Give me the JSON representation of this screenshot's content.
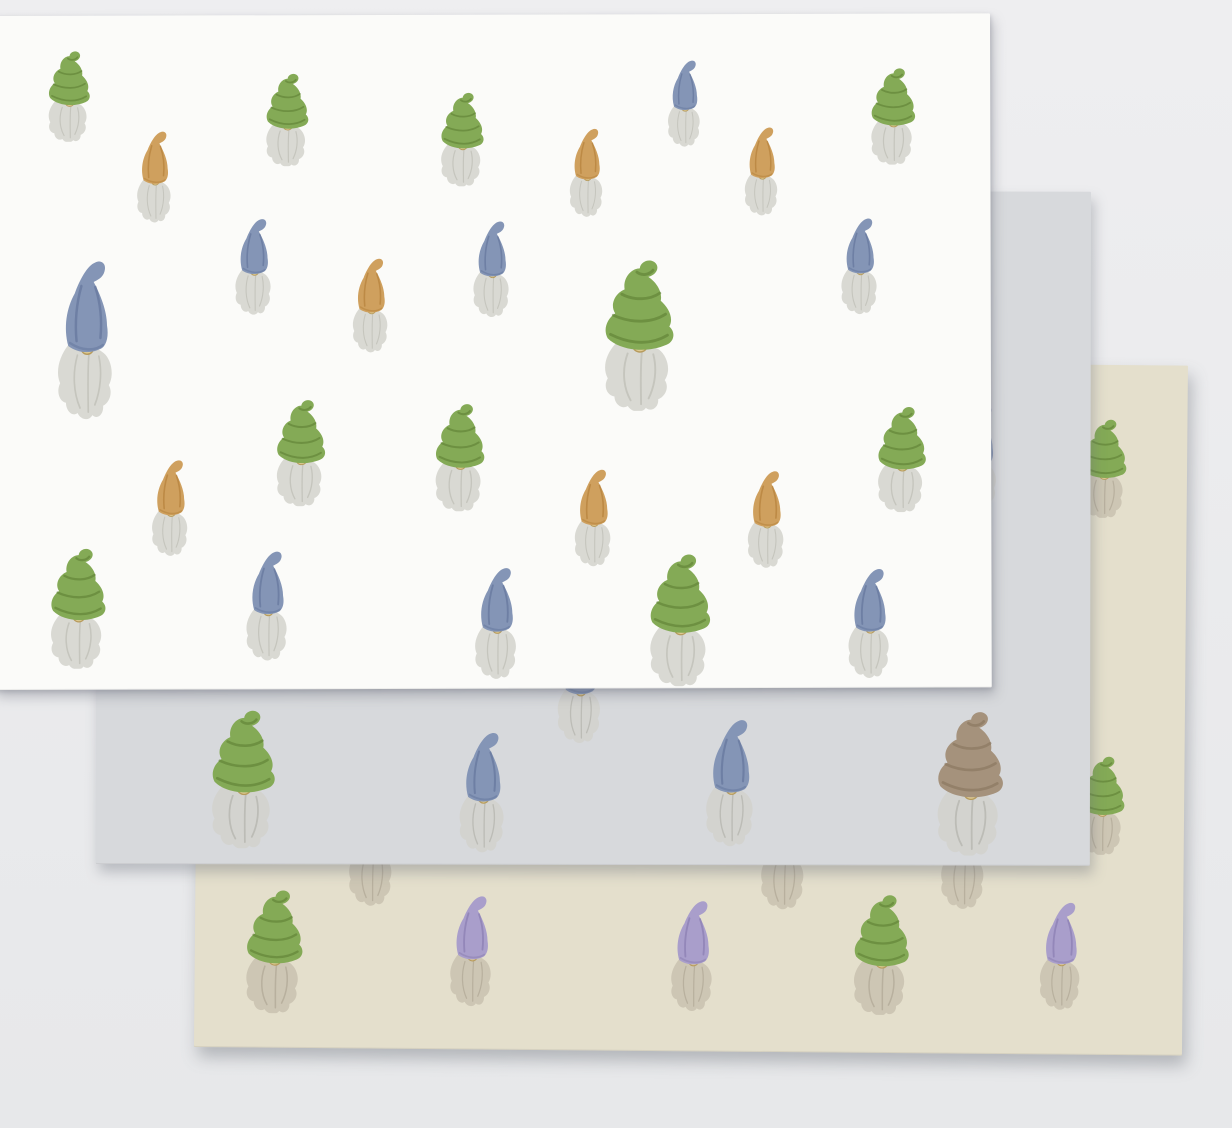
{
  "scene": {
    "type": "product-photo",
    "subject": "Three overlapping wrapping paper sheets with a watercolor gnome pattern",
    "background_top": "#eeeef0",
    "background_bottom": "#e7e8ea",
    "palette": {
      "nose": "#decb93",
      "nose_stroke": "#b79b5c",
      "hats": {
        "green": {
          "fill": "#84aa56",
          "stripe": "#5d7e33"
        },
        "orange": {
          "fill": "#cfa05e",
          "stripe": "#b07c36"
        },
        "blue": {
          "fill": "#8495b6",
          "stripe": "#5f7198"
        },
        "purple": {
          "fill": "#a99ecb",
          "stripe": "#8578ad"
        },
        "taupe": {
          "fill": "#a5927c",
          "stripe": "#87745e"
        }
      }
    },
    "sheets": [
      {
        "id": "beige",
        "label": "beige sheet (back)",
        "color": "#e4dfcc",
        "beard_color": "#cdc6b4",
        "beard_stroke": "#a89f8c",
        "x": 200,
        "y": 357,
        "width": 988,
        "height": 690,
        "rotation_deg": 0.5,
        "gnomes": [
          {
            "hat": "green",
            "style": "swirl",
            "cx": 906,
            "cy": 103,
            "h": 100
          },
          {
            "hat": "green",
            "style": "swirl",
            "cx": 907,
            "cy": 440,
            "h": 100
          },
          {
            "hat": "purple",
            "style": "point",
            "cx": 178,
            "cy": 488,
            "h": 120
          },
          {
            "hat": "purple",
            "style": "point",
            "cx": 590,
            "cy": 488,
            "h": 120
          },
          {
            "hat": "purple",
            "style": "point",
            "cx": 770,
            "cy": 486,
            "h": 120
          },
          {
            "hat": "green",
            "style": "swirl",
            "cx": 81,
            "cy": 593,
            "h": 125
          },
          {
            "hat": "purple",
            "style": "point",
            "cx": 279,
            "cy": 590,
            "h": 115
          },
          {
            "hat": "purple",
            "style": "point",
            "cx": 500,
            "cy": 593,
            "h": 115
          },
          {
            "hat": "green",
            "style": "swirl",
            "cx": 688,
            "cy": 591,
            "h": 122
          },
          {
            "hat": "purple",
            "style": "point",
            "cx": 868,
            "cy": 590,
            "h": 112
          }
        ]
      },
      {
        "id": "gray",
        "label": "gray sheet (middle)",
        "color": "#d7d9dc",
        "beard_color": "#d3d3cf",
        "beard_stroke": "#aaaaa2",
        "x": 97,
        "y": 190,
        "width": 994,
        "height": 674,
        "rotation_deg": 0.1,
        "gnomes": [
          {
            "hat": "blue",
            "style": "point",
            "cx": 883,
            "cy": 265,
            "h": 110
          },
          {
            "hat": "blue",
            "style": "point",
            "cx": 486,
            "cy": 493,
            "h": 120
          },
          {
            "hat": "green",
            "style": "swirl",
            "cx": 149,
            "cy": 588,
            "h": 140
          },
          {
            "hat": "blue",
            "style": "point",
            "cx": 389,
            "cy": 600,
            "h": 125
          },
          {
            "hat": "blue",
            "style": "point",
            "cx": 637,
            "cy": 590,
            "h": 132
          },
          {
            "hat": "taupe",
            "style": "swirl",
            "cx": 876,
            "cy": 591,
            "h": 146
          }
        ]
      },
      {
        "id": "white",
        "label": "white sheet (front)",
        "color": "#fbfbf9",
        "beard_color": "#d9d9d3",
        "beard_stroke": "#b4b4ab",
        "x": -8,
        "y": 16,
        "width": 998,
        "height": 674,
        "rotation_deg": -0.15,
        "gnomes": [
          {
            "hat": "green",
            "style": "swirl",
            "cx": 78,
            "cy": 80,
            "h": 92
          },
          {
            "hat": "green",
            "style": "swirl",
            "cx": 296,
            "cy": 104,
            "h": 94
          },
          {
            "hat": "green",
            "style": "swirl",
            "cx": 471,
            "cy": 124,
            "h": 95
          },
          {
            "hat": "blue",
            "style": "point",
            "cx": 694,
            "cy": 88,
            "h": 90
          },
          {
            "hat": "green",
            "style": "swirl",
            "cx": 902,
            "cy": 102,
            "h": 98
          },
          {
            "hat": "orange",
            "style": "point",
            "cx": 164,
            "cy": 160,
            "h": 95
          },
          {
            "hat": "orange",
            "style": "point",
            "cx": 596,
            "cy": 157,
            "h": 92
          },
          {
            "hat": "orange",
            "style": "point",
            "cx": 771,
            "cy": 156,
            "h": 92
          },
          {
            "hat": "blue",
            "style": "point",
            "cx": 263,
            "cy": 250,
            "h": 100
          },
          {
            "hat": "blue",
            "style": "point",
            "cx": 96,
            "cy": 322,
            "h": 165,
            "ar": 0.5
          },
          {
            "hat": "orange",
            "style": "point",
            "cx": 380,
            "cy": 289,
            "h": 98
          },
          {
            "hat": "blue",
            "style": "point",
            "cx": 501,
            "cy": 253,
            "h": 100
          },
          {
            "hat": "green",
            "style": "swirl",
            "cx": 648,
            "cy": 320,
            "h": 153
          },
          {
            "hat": "blue",
            "style": "point",
            "cx": 869,
            "cy": 251,
            "h": 100
          },
          {
            "hat": "green",
            "style": "swirl",
            "cx": 309,
            "cy": 437,
            "h": 108
          },
          {
            "hat": "green",
            "style": "swirl",
            "cx": 468,
            "cy": 442,
            "h": 109
          },
          {
            "hat": "orange",
            "style": "point",
            "cx": 179,
            "cy": 491,
            "h": 100
          },
          {
            "hat": "orange",
            "style": "point",
            "cx": 602,
            "cy": 502,
            "h": 101
          },
          {
            "hat": "orange",
            "style": "point",
            "cx": 775,
            "cy": 504,
            "h": 101
          },
          {
            "hat": "green",
            "style": "swirl",
            "cx": 910,
            "cy": 445,
            "h": 107
          },
          {
            "hat": "green",
            "style": "swirl",
            "cx": 86,
            "cy": 592,
            "h": 122
          },
          {
            "hat": "blue",
            "style": "point",
            "cx": 276,
            "cy": 589,
            "h": 114
          },
          {
            "hat": "blue",
            "style": "point",
            "cx": 505,
            "cy": 607,
            "h": 116
          },
          {
            "hat": "green",
            "style": "swirl",
            "cx": 688,
            "cy": 605,
            "h": 134
          },
          {
            "hat": "blue",
            "style": "point",
            "cx": 878,
            "cy": 608,
            "h": 114
          }
        ]
      }
    ]
  }
}
